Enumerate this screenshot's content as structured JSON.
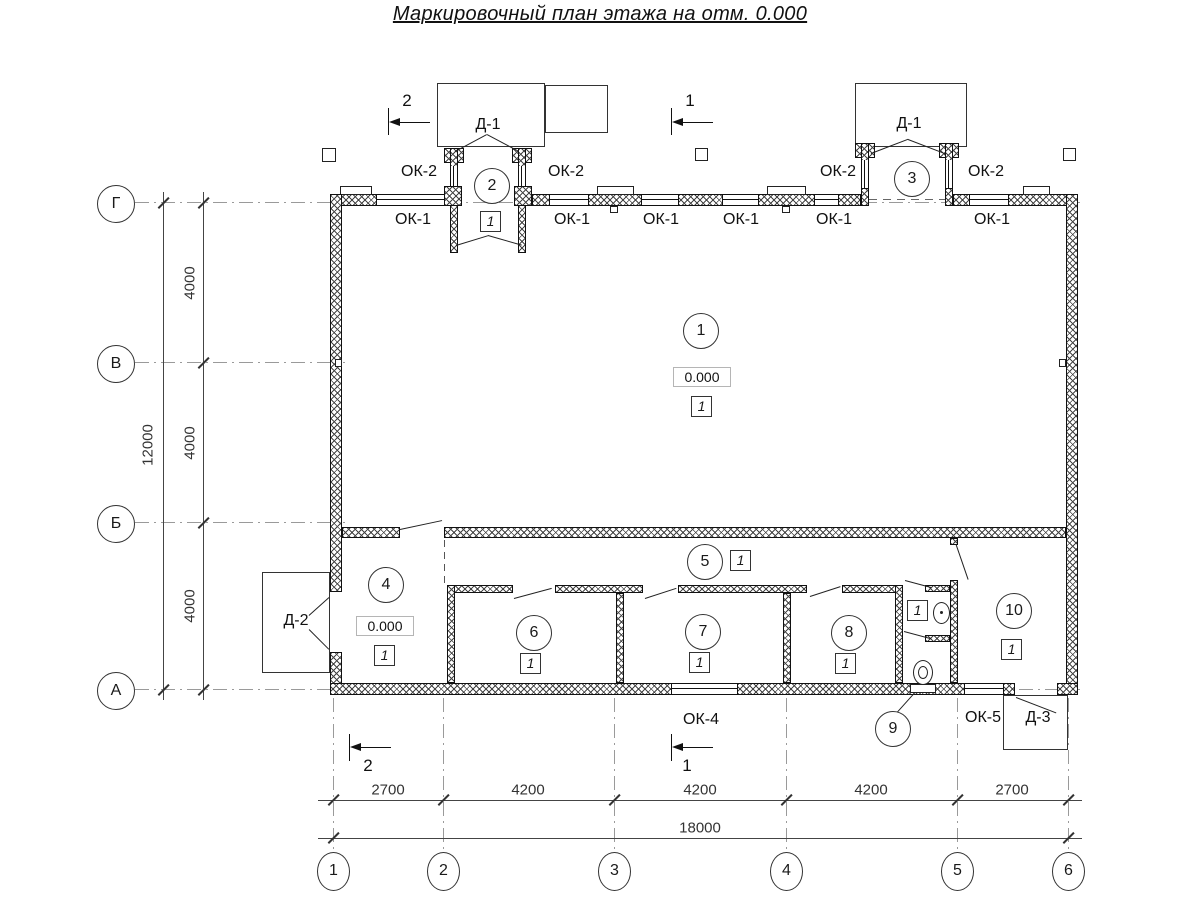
{
  "title": "Маркировочный план этажа на отм. 0.000",
  "colors": {
    "line": "#1a1a1a",
    "dim": "#555555",
    "axis": "#9a9a9a"
  },
  "axis_columns": [
    "1",
    "2",
    "3",
    "4",
    "5",
    "6"
  ],
  "axis_rows": [
    "Г",
    "В",
    "Б",
    "А"
  ],
  "dims": {
    "bottom_segments": [
      "2700",
      "4200",
      "4200",
      "4200",
      "2700"
    ],
    "bottom_total": "18000",
    "left_segments": [
      "4000",
      "4000",
      "4000"
    ],
    "left_total": "12000"
  },
  "labels": {
    "ok1": "ОК-1",
    "ok2": "ОК-2",
    "ok4": "ОК-4",
    "ok5": "ОК-5",
    "d1": "Д-1",
    "d2": "Д-2",
    "d3": "Д-3"
  },
  "section_marks": {
    "s1": "1",
    "s2": "2"
  },
  "rooms": {
    "r1": {
      "number": "1",
      "elevation": "0.000",
      "floor_type": "1"
    },
    "r2": {
      "number": "2",
      "floor_type": "1"
    },
    "r3": {
      "number": "3"
    },
    "r4": {
      "number": "4",
      "elevation": "0.000",
      "floor_type": "1"
    },
    "r5": {
      "number": "5",
      "floor_type": "1"
    },
    "r6": {
      "number": "6",
      "floor_type": "1"
    },
    "r7": {
      "number": "7",
      "floor_type": "1"
    },
    "r8": {
      "number": "8",
      "floor_type": "1"
    },
    "r9": {
      "number": "9",
      "floor_type": "1"
    },
    "r10": {
      "number": "10",
      "floor_type": "1"
    }
  }
}
